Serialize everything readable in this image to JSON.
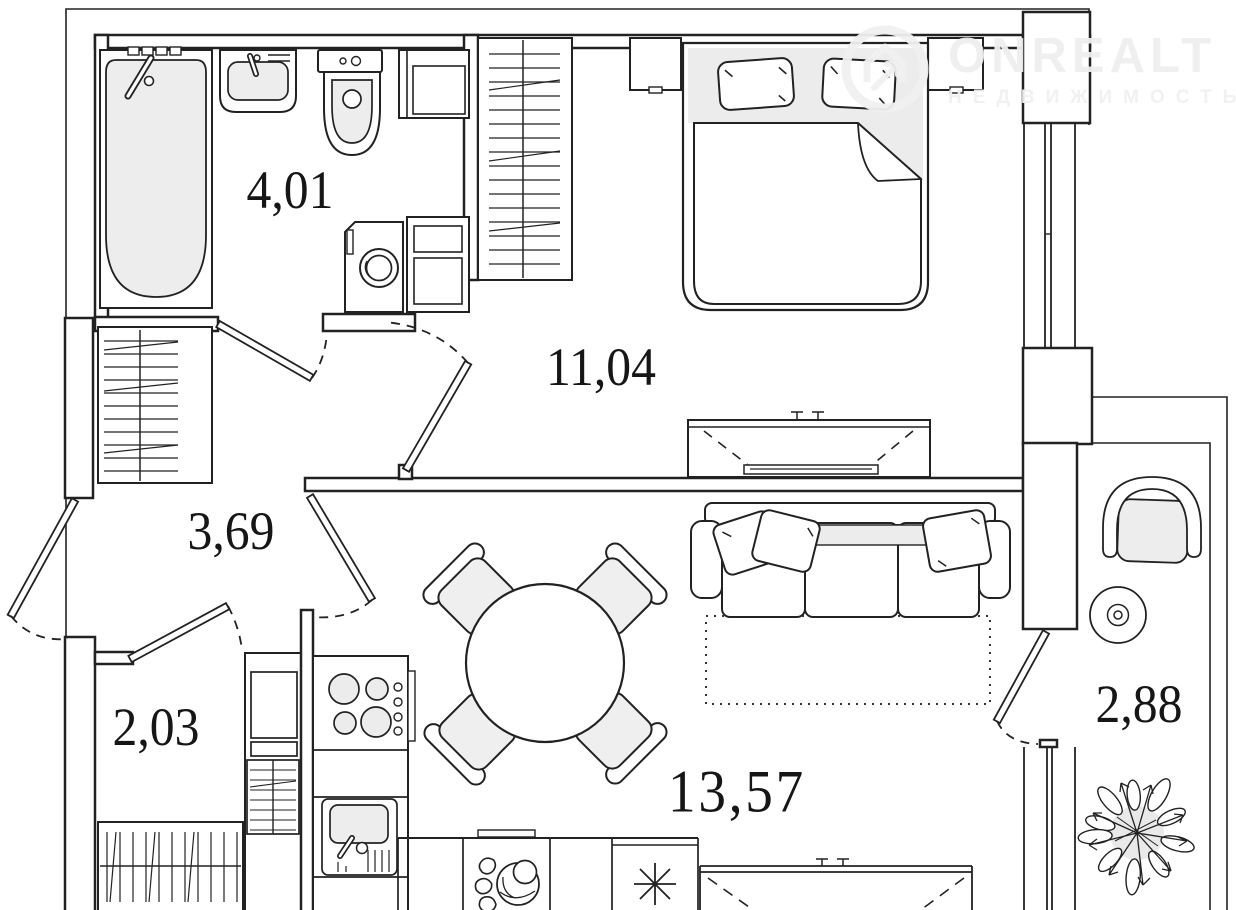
{
  "plan": {
    "labels": {
      "bathroom": "4,01",
      "bedroom": "11,04",
      "hallway": "3,69",
      "closet": "2,03",
      "kitchen_living": "13,57",
      "balcony": "2,88"
    }
  },
  "watermark": {
    "brand": "ONREALT",
    "subtitle": "НЕДВИЖИМОСТЬ"
  },
  "colors": {
    "line": "#222222",
    "room_fill": "#ffffff",
    "furniture_fill": "#ededed",
    "watermark": "#efefef",
    "label_text": "#161616"
  }
}
